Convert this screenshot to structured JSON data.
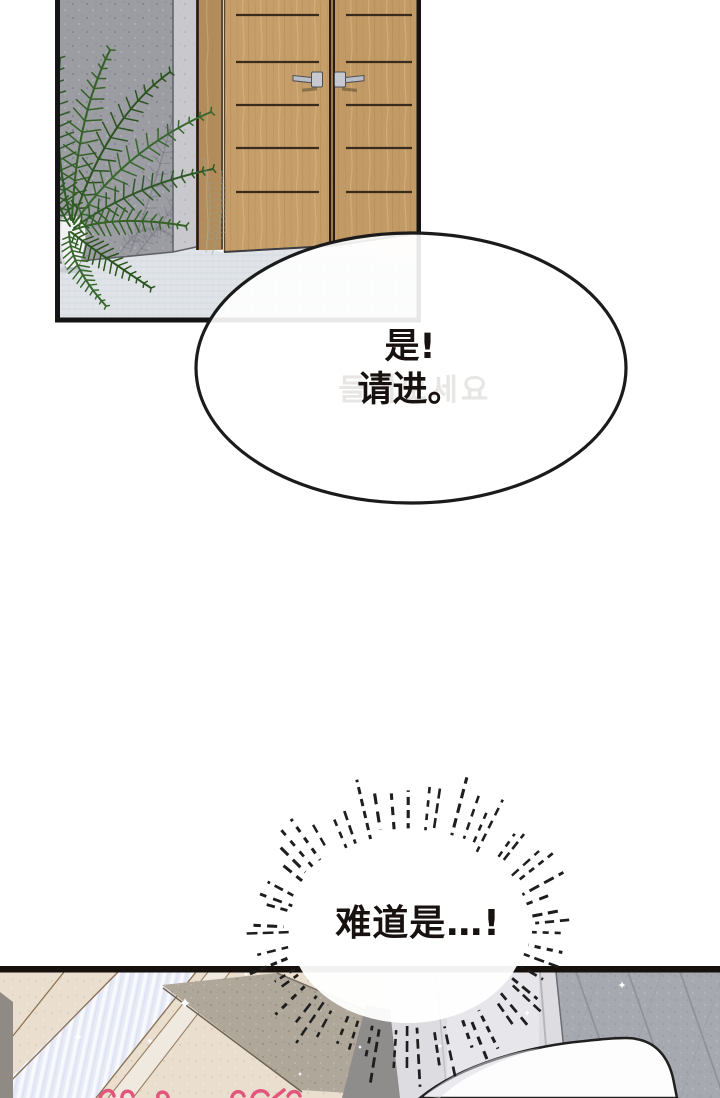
{
  "comic": {
    "background_color": "#ffffff",
    "panels": {
      "entrance": {
        "description": "Entrance: gray speckled stone pillar with potted fern beside wooden double doors on a light woven-tile floor",
        "border_color": "#141414",
        "pillar_color": "#9c9ca3",
        "door_wood_color": "#c69e6a",
        "door_frame_color": "#b28c5b",
        "floor_color": "#e0e4e8",
        "fern_color": "#31592a",
        "pot_color": "#f2f2f4",
        "handle_color": "#c6cad0"
      },
      "hallway": {
        "description": "Hallway corner: glowing doorway light, cream stone wall, taupe wall, gray wall panels, diamond-tiled wall and white bedding",
        "border_color": "#16110d",
        "cream_wall_color": "#eadfcf",
        "taupe_wall_color": "#b0a79b",
        "doorway_light_color": "#e8ebf6",
        "panel_wall_color": "#dddde1",
        "tile_wall_color": "#a7a9b0",
        "bedding_color": "#fdfdfe",
        "sparkle_color": "#ffffff",
        "signature_color": "#e2567d"
      }
    },
    "speech_bubble": {
      "line1": "是!",
      "line2": "请进。",
      "ghost_text": "들어오세요",
      "text_color": "#171210",
      "outline_color": "#1b1b1b"
    },
    "burst_bubble": {
      "text": "难道是…!",
      "text_color": "#171210",
      "ray_color": "#1e1e1e"
    }
  }
}
